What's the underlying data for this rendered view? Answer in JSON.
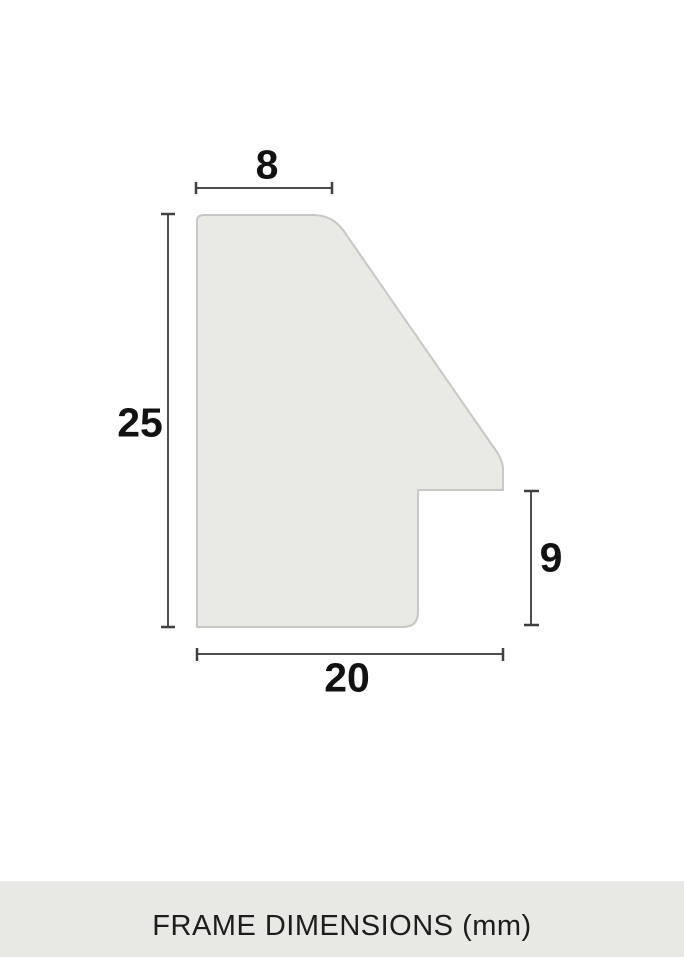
{
  "caption": "FRAME DIMENSIONS (mm)",
  "dimensions": {
    "top_width": {
      "label": "8"
    },
    "left_height": {
      "label": "25"
    },
    "right_height": {
      "label": "9"
    },
    "bottom_width": {
      "label": "20"
    }
  },
  "colors": {
    "background": "#ffffff",
    "caption_band": "#e8e8e4",
    "profile_fill": "#e9e9e5",
    "profile_stroke": "#c7c7c3",
    "dimension_line": "#4d4d4d",
    "label_text": "#121212"
  }
}
